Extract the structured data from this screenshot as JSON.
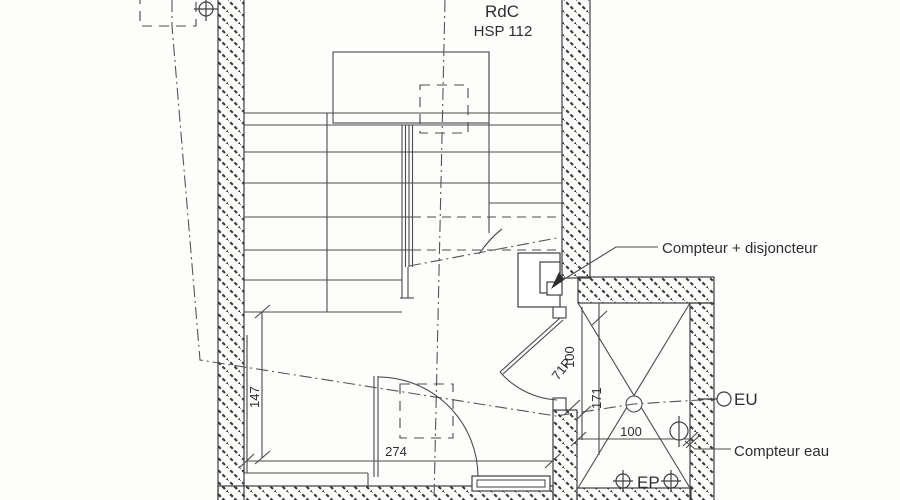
{
  "meta": {
    "floor_label": "RdC",
    "ceiling_height_label": "HSP 112"
  },
  "labels": {
    "electric_meter": "Compteur + disjoncteur",
    "waste_water": "EU",
    "water_meter": "Compteur eau",
    "rain_water": "EP"
  },
  "dimensions": {
    "interior_depth": "147",
    "interior_width": "274",
    "door_tag": "71P",
    "door_clear": "100",
    "duct_depth": "171",
    "duct_width": "100"
  },
  "colors": {
    "line": "#3f3f3f",
    "background": "#fdfdfc"
  }
}
